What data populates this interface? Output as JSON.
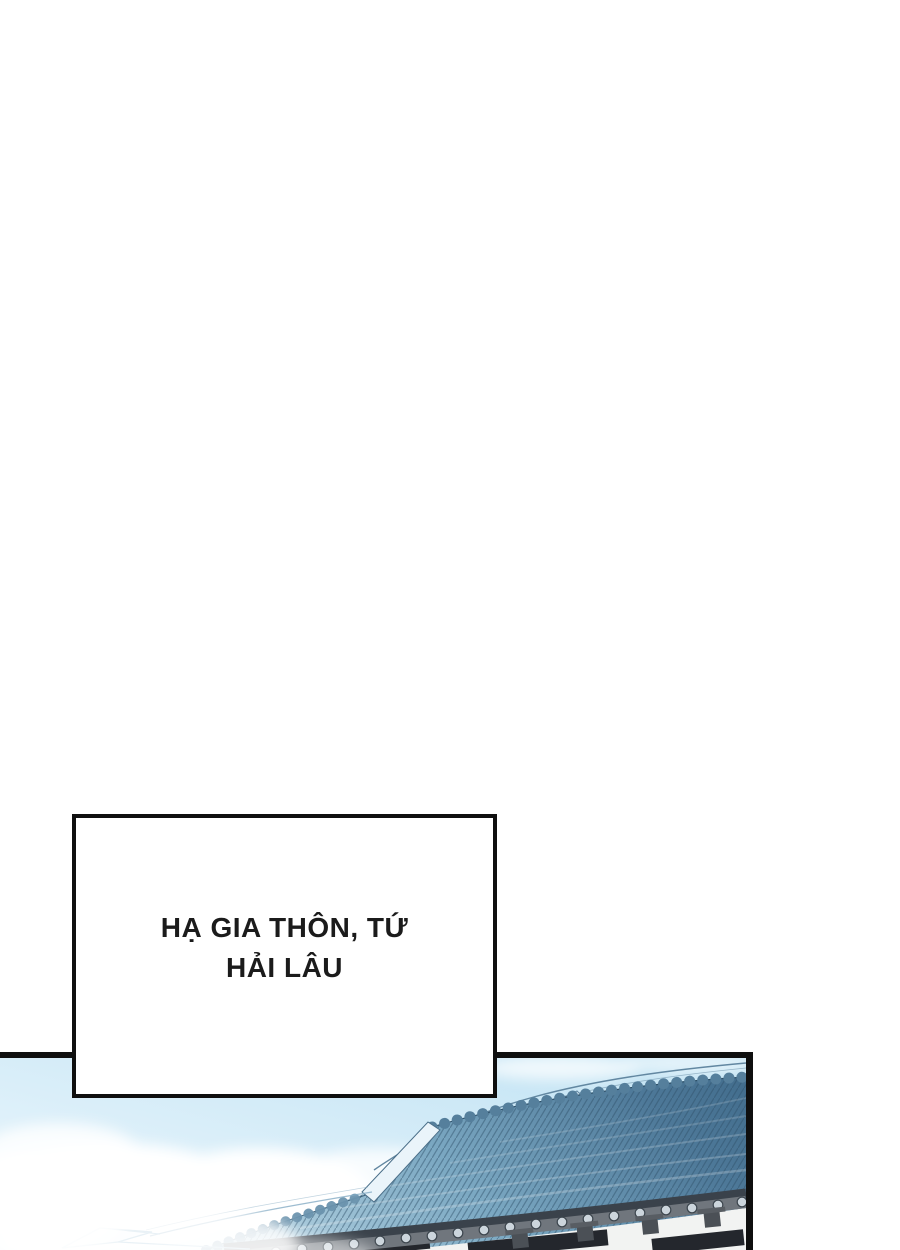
{
  "page": {
    "width_px": 900,
    "height_px": 1250,
    "background": "#ffffff"
  },
  "caption": {
    "line1": "HẠ GIA THÔN, TỨ",
    "line2": "HẢI LÂU",
    "full_text": "HẠ GIA THÔN, TỨ HẢI LÂU"
  },
  "panel": {
    "type": "comic-panel-illustration",
    "subject": "curved blue-tiled traditional roof with scalloped ridge, eave tile caps, white wall with dark windows, sky and clouds",
    "colors": {
      "border": "#0f0f0f",
      "sky_light": "#f0f9fd",
      "sky_blue": "#bfe2f3",
      "cloud": "#ffffff",
      "roof_light": "#a6c8da",
      "roof_mid": "#7ba8c2",
      "roof_dark": "#4d7898",
      "roof_deep": "#426d8d",
      "tile_line": "#2e5068",
      "ridge_tile": "#557f9c",
      "verge_fill": "#eaf4fa",
      "verge_line": "#4a6e88",
      "eave_fascia": "#70767d",
      "eave_shadow": "#3a424b",
      "tile_cap": "#ccd5dc",
      "tile_cap_line": "#3c454d",
      "bracket": "#4b5056",
      "wall": "#f2f3f2",
      "window": "#24272d",
      "distant_line": "#8fb9d2"
    }
  }
}
